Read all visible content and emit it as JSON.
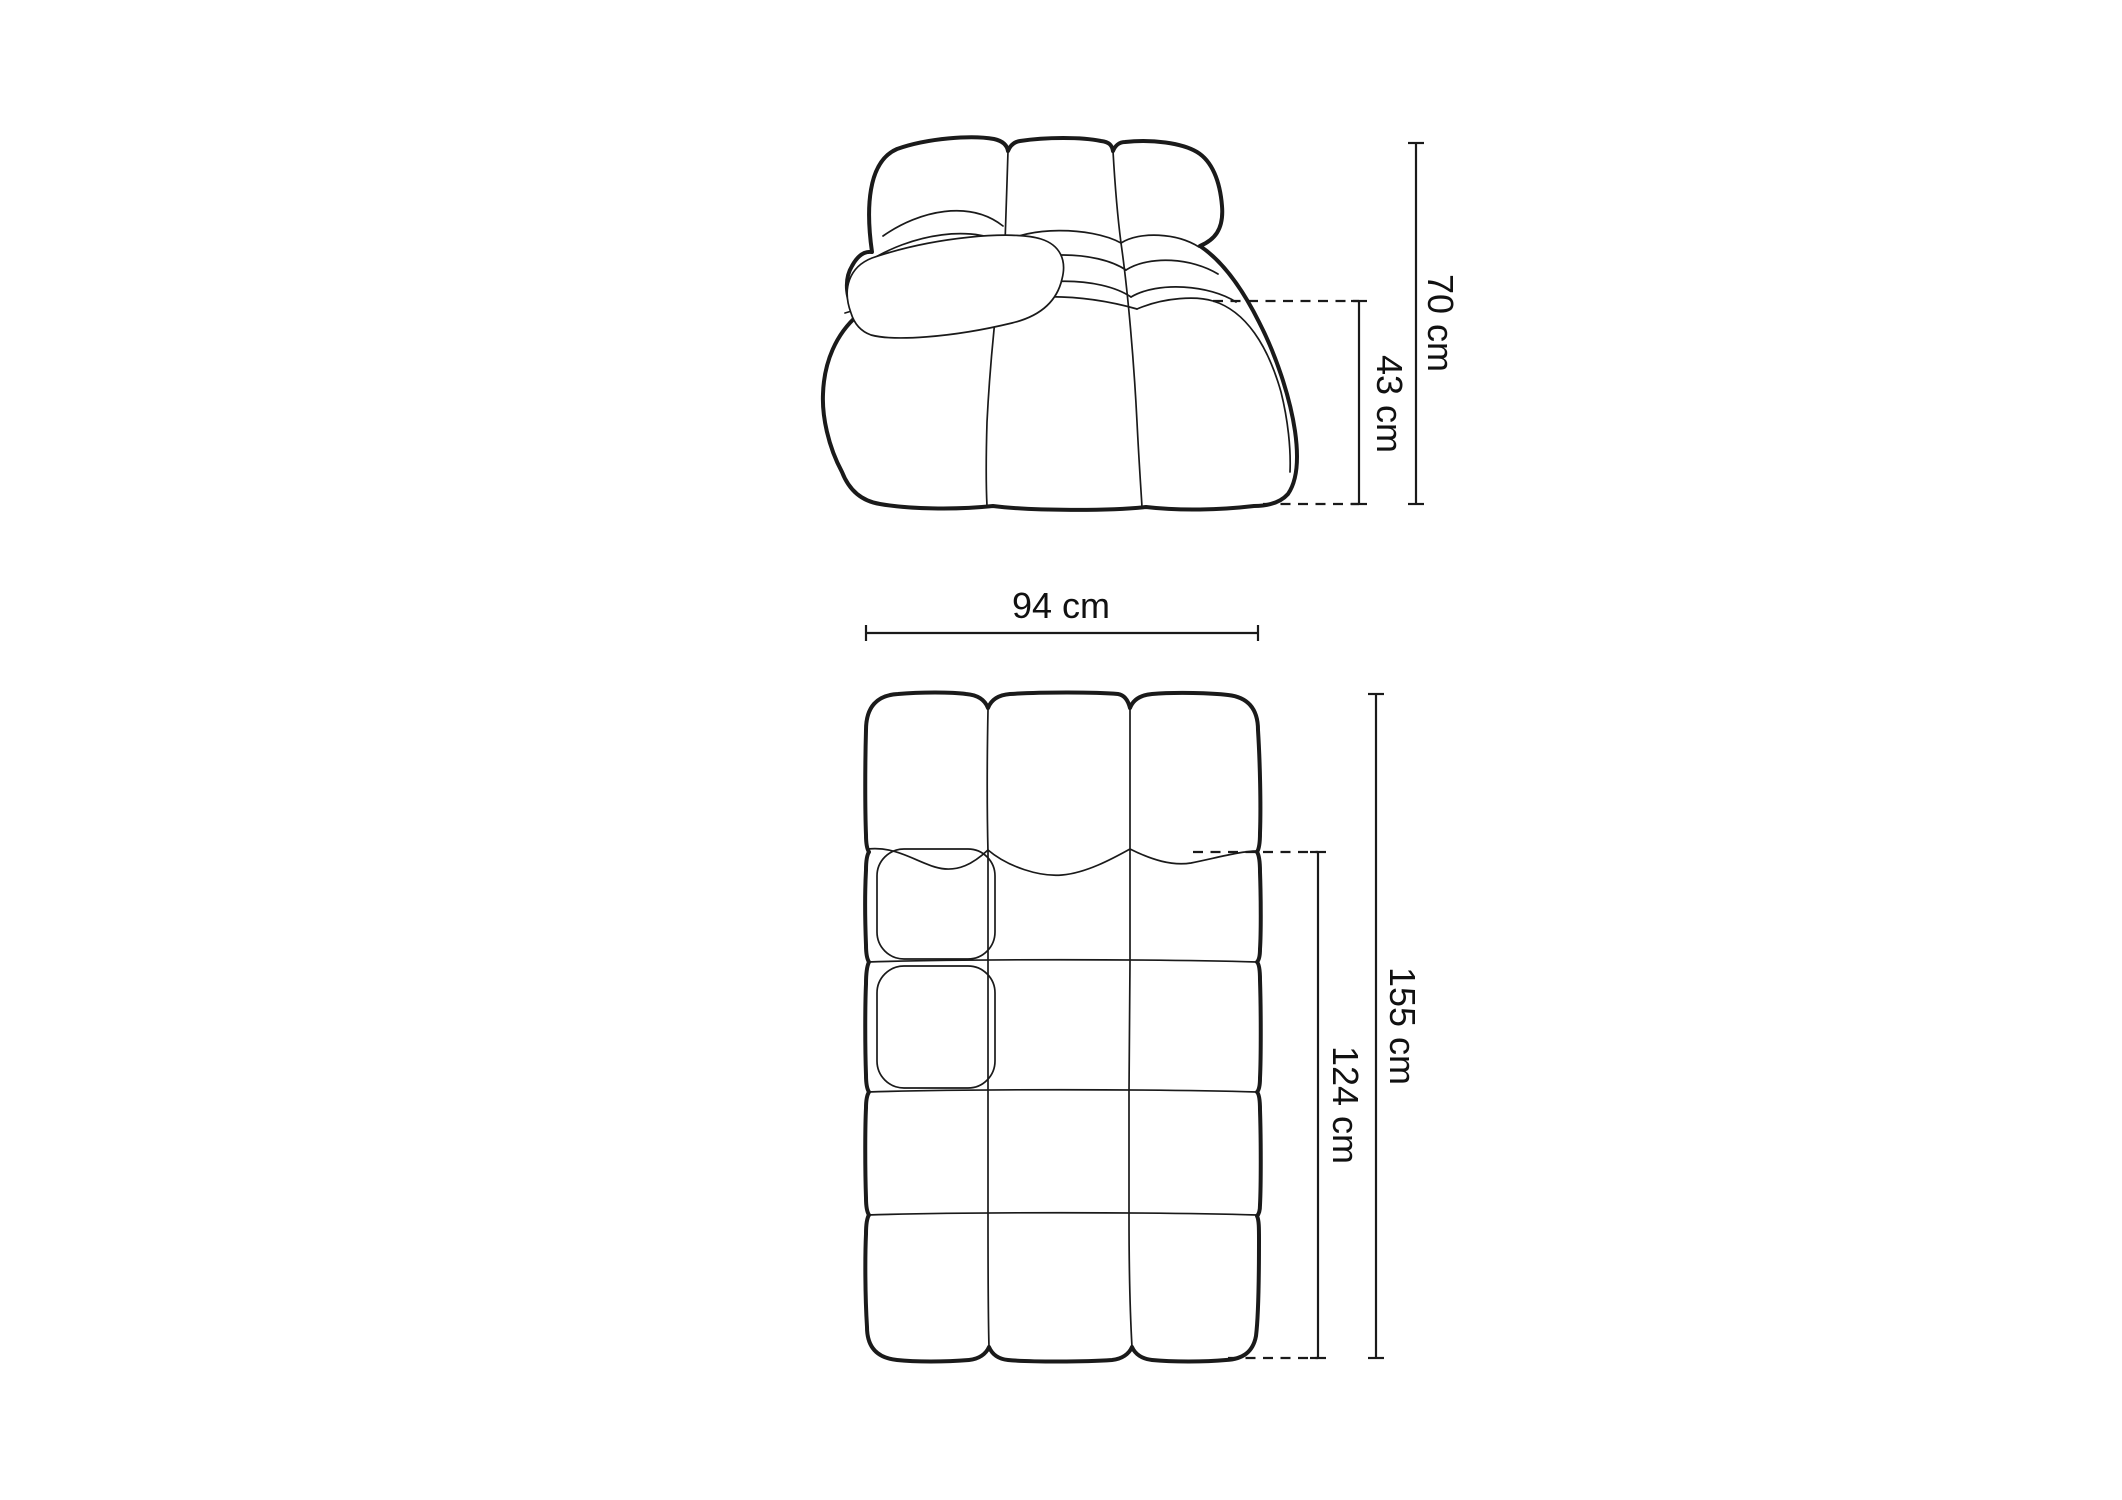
{
  "front_view": {
    "total_height_label": "70 cm",
    "seat_height_label": "43 cm"
  },
  "top_view": {
    "width_label": "94 cm",
    "total_depth_label": "155 cm",
    "seat_depth_label": "124 cm"
  },
  "colors": {
    "background": "#ffffff",
    "line": "#1a1a1a",
    "text": "#111111"
  }
}
